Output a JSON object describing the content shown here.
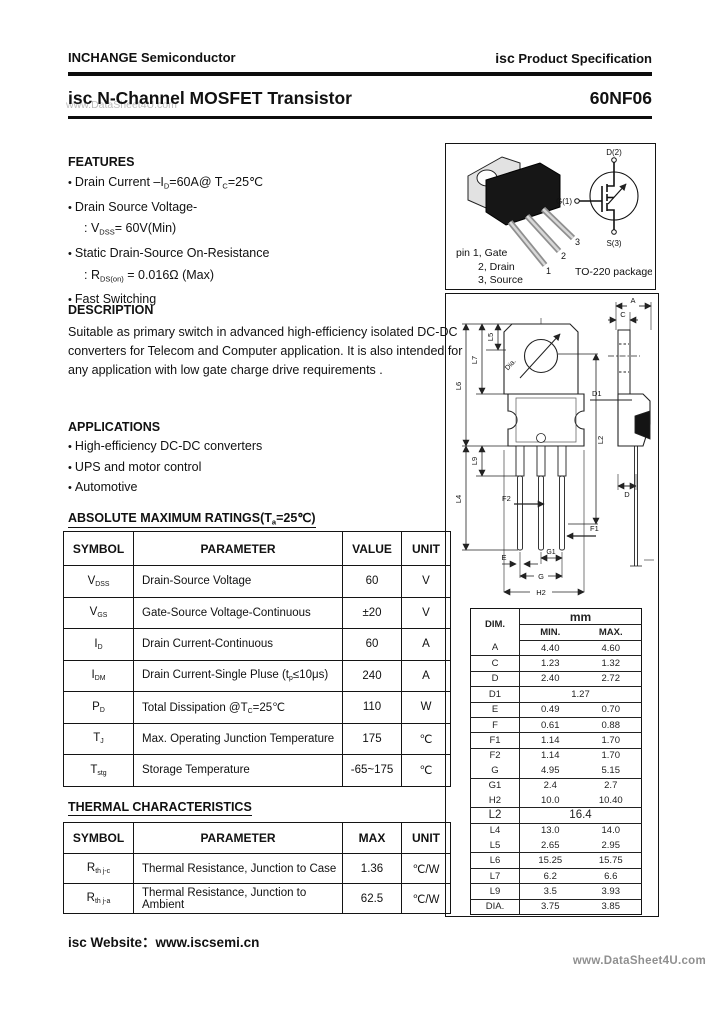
{
  "header": {
    "company": "INCHANGE Semiconductor",
    "brand": "isc",
    "spec": "Product Specification"
  },
  "title": {
    "product_line": "isc N-Channel MOSFET Transistor",
    "part_number": "60NF06",
    "watermark": "www.DataSheet4U.com"
  },
  "features": {
    "heading": "FEATURES",
    "items": [
      {
        "bullet": true,
        "text": "Drain Current –I_{D}=60A@ T_{C}=25℃"
      },
      {
        "bullet": true,
        "text": "Drain Source Voltage-"
      },
      {
        "bullet": false,
        "text": ": V_{DSS}= 60V(Min)"
      },
      {
        "bullet": true,
        "text": "Static Drain-Source On-Resistance"
      },
      {
        "bullet": false,
        "text": ": R_{DS(on)} = 0.016Ω (Max)"
      },
      {
        "bullet": true,
        "text": "Fast Switching"
      }
    ]
  },
  "description": {
    "heading": "DESCRIPTION",
    "text": "Suitable as primary switch in advanced high-efficiency isolated DC-DC converters for Telecom and Computer application. It is also intended for any application with low gate charge drive requirements ."
  },
  "applications": {
    "heading": "APPLICATIONS",
    "items": [
      {
        "bullet": true,
        "text": "High-efficiency DC-DC converters"
      },
      {
        "bullet": true,
        "text": "UPS and motor control"
      },
      {
        "bullet": true,
        "text": "Automotive"
      }
    ]
  },
  "package_box": {
    "pin_line1": "pin 1, Gate",
    "pin_line2": "2, Drain",
    "pin_line3": "3, Source",
    "package_name": "TO-220 package",
    "lead_numbers": [
      "1",
      "2",
      "3"
    ],
    "schematic": {
      "drain": "D(2)",
      "gate": "G(1)",
      "source": "S(3)"
    }
  },
  "abs_max": {
    "heading": "ABSOLUTE MAXIMUM RATINGS(T_{a}=25℃)",
    "columns": [
      "SYMBOL",
      "PARAMETER",
      "VALUE",
      "UNIT"
    ],
    "rows": [
      {
        "symbol": "V_{DSS}",
        "parameter": "Drain-Source Voltage",
        "value": "60",
        "unit": "V",
        "sep": false
      },
      {
        "symbol": "V_{GS}",
        "parameter": "Gate-Source Voltage-Continuous",
        "value": "±20",
        "unit": "V",
        "sep": true
      },
      {
        "symbol": "I_{D}",
        "parameter": "Drain Current-Continuous",
        "value": "60",
        "unit": "A",
        "sep": true
      },
      {
        "symbol": "I_{DM}",
        "parameter": "Drain Current-Single Pluse (t_{p}≤10μs)",
        "value": "240",
        "unit": "A",
        "sep": true
      },
      {
        "symbol": "P_{D}",
        "parameter": "Total Dissipation @T_{C}=25℃",
        "value": "110",
        "unit": "W",
        "sep": false
      },
      {
        "symbol": "T_{J}",
        "parameter": "Max. Operating Junction Temperature",
        "value": "175",
        "unit": "℃",
        "sep": true
      },
      {
        "symbol": "T_{stg}",
        "parameter": "Storage Temperature",
        "value": "-65~175",
        "unit": "℃",
        "sep": true
      }
    ]
  },
  "thermal": {
    "heading": "THERMAL CHARACTERISTICS",
    "columns": [
      "SYMBOL",
      "PARAMETER",
      "MAX",
      "UNIT"
    ],
    "rows": [
      {
        "symbol": "R_{th j-c}",
        "parameter": "Thermal Resistance, Junction to Case",
        "value": "1.36",
        "unit": "℃/W",
        "sep": true
      },
      {
        "symbol": "R_{th j-a}",
        "parameter": "Thermal Resistance, Junction to Ambient",
        "value": "62.5",
        "unit": "℃/W",
        "sep": true
      }
    ]
  },
  "dimensions": {
    "dim_header": "DIM.",
    "unit_header": "mm",
    "min_header": "MIN.",
    "max_header": "MAX.",
    "rows": [
      {
        "dim": "A",
        "min": "4.40",
        "max": "4.60",
        "sep": true
      },
      {
        "dim": "C",
        "min": "1.23",
        "max": "1.32",
        "sep": true
      },
      {
        "dim": "D",
        "min": "2.40",
        "max": "2.72",
        "sep": true
      },
      {
        "dim": "D1",
        "min": "1.27",
        "sep": true
      },
      {
        "dim": "E",
        "min": "0.49",
        "max": "0.70",
        "sep": true
      },
      {
        "dim": "F",
        "min": "0.61",
        "max": "0.88",
        "sep": true
      },
      {
        "dim": "F1",
        "min": "1.14",
        "max": "1.70",
        "sep": true
      },
      {
        "dim": "F2",
        "min": "1.14",
        "max": "1.70",
        "sep": false
      },
      {
        "dim": "G",
        "min": "4.95",
        "max": "5.15",
        "sep": true
      },
      {
        "dim": "G1",
        "min": "2.4",
        "max": "2.7",
        "sep": false
      },
      {
        "dim": "H2",
        "min": "10.0",
        "max": "10.40",
        "sep": true
      },
      {
        "dim": "L2",
        "min": "16.4",
        "sep": true,
        "big": true
      },
      {
        "dim": "L4",
        "min": "13.0",
        "max": "14.0",
        "sep": false
      },
      {
        "dim": "L5",
        "min": "2.65",
        "max": "2.95",
        "sep": true
      },
      {
        "dim": "L6",
        "min": "15.25",
        "max": "15.75",
        "sep": true
      },
      {
        "dim": "L7",
        "min": "6.2",
        "max": "6.6",
        "sep": true
      },
      {
        "dim": "L9",
        "min": "3.5",
        "max": "3.93",
        "sep": true
      },
      {
        "dim": "DIA.",
        "min": "3.75",
        "max": "3.85",
        "sep": true
      }
    ],
    "labels": {
      "A": "A",
      "C": "C",
      "D": "D",
      "D1": "D1",
      "E": "E",
      "F1": "F1",
      "F2": "F2",
      "G": "G",
      "G1": "G1",
      "H2": "H2",
      "L2": "L2",
      "L4": "L4",
      "L5": "L5",
      "L6": "L6",
      "L7": "L7",
      "L9": "L9",
      "Dia": "Dia."
    }
  },
  "footer": {
    "website": "isc Website：www.iscsemi.cn",
    "watermark": "www.DataSheet4U.com"
  }
}
